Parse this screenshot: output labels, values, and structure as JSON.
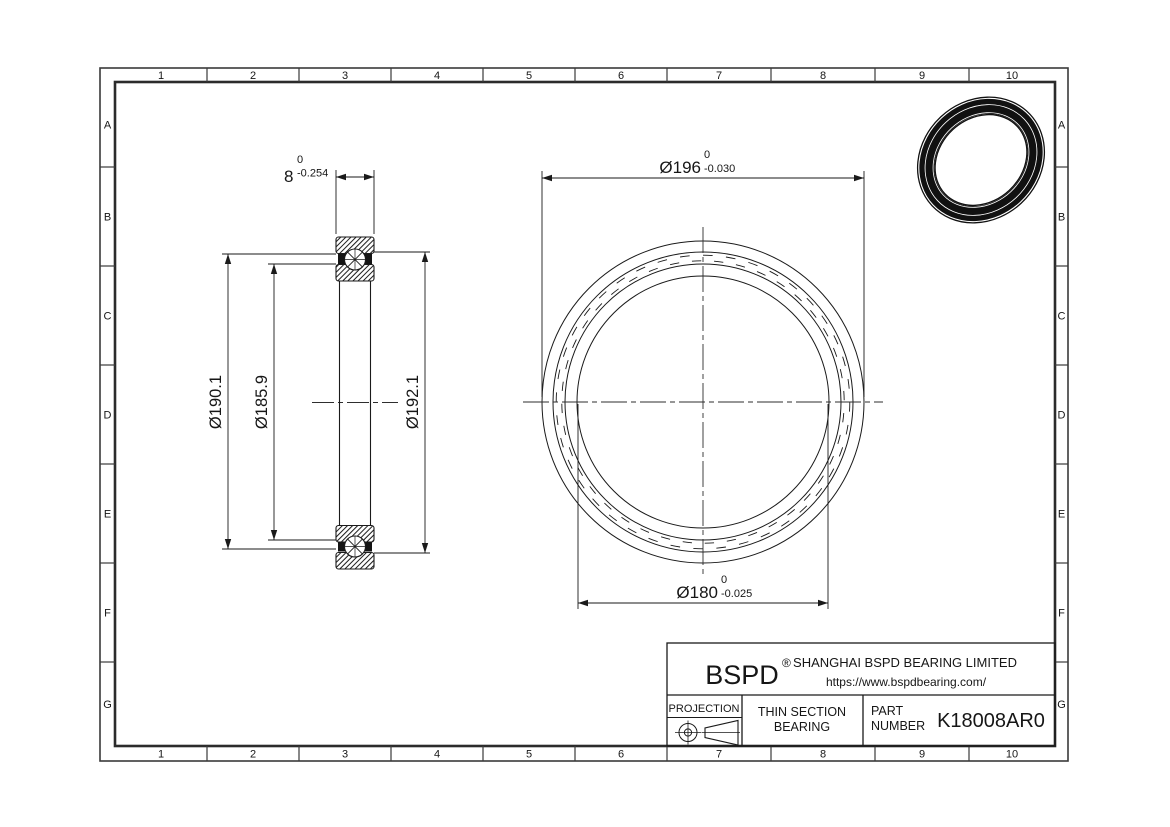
{
  "drawing": {
    "grid": {
      "columns": [
        "1",
        "2",
        "3",
        "4",
        "5",
        "6",
        "7",
        "8",
        "9",
        "10"
      ],
      "rows": [
        "A",
        "B",
        "C",
        "D",
        "E",
        "F",
        "G"
      ]
    },
    "dimensions": {
      "width": {
        "value": "8",
        "tol_upper": "0",
        "tol_lower": "-0.254"
      },
      "outer_diameter": {
        "value": "Ø196",
        "tol_upper": "0",
        "tol_lower": "-0.030"
      },
      "bore_diameter": {
        "value": "Ø180",
        "tol_upper": "0",
        "tol_lower": "-0.025"
      },
      "outer_race_diameter": {
        "value": "Ø190.1"
      },
      "pitch_diameter": {
        "value": "Ø185.9"
      },
      "inner_race_diameter": {
        "value": "Ø192.1"
      }
    },
    "title_block": {
      "brand": "BSPD",
      "registered_mark": "®",
      "company": "SHANGHAI BSPD BEARING LIMITED",
      "website": "https://www.bspdbearing.com/",
      "projection_label": "PROJECTION",
      "product_type_line1": "THIN SECTION",
      "product_type_line2": "BEARING",
      "part_label_line1": "PART",
      "part_label_line2": "NUMBER",
      "part_number": "K18008AR0"
    },
    "colors": {
      "line": "#1a1a1a",
      "frame": "#3a3a3a",
      "background": "#ffffff"
    }
  }
}
